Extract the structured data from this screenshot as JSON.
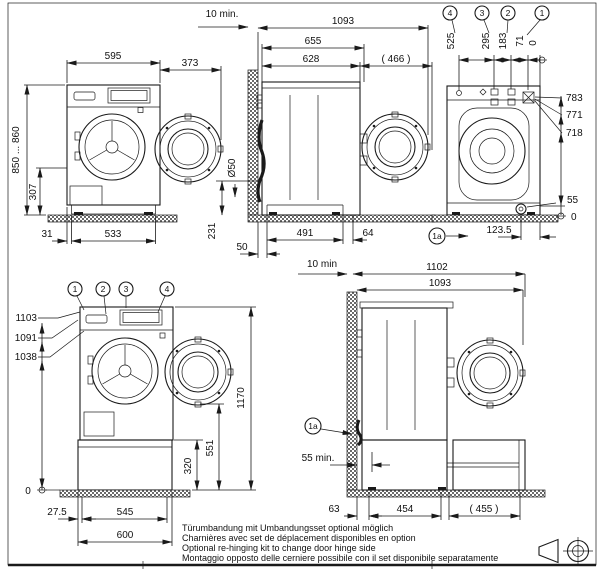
{
  "front": {
    "w": "595",
    "door": "373",
    "h": "850 ... 860",
    "drain_h": "307",
    "inset": "31",
    "base": "533"
  },
  "side": {
    "gap": "10 min.",
    "total": "1093",
    "with_door": "655",
    "body": "628",
    "swing": "( 466 )",
    "drain_dia": "Ø50",
    "drain_h": "231",
    "rear": "50",
    "base": "491",
    "front": "64"
  },
  "rear": {
    "c1": "1",
    "c2": "2",
    "c3": "3",
    "c4": "4",
    "c1a": "1a",
    "p4": "525",
    "p3": "295",
    "p2": "183",
    "p1": "71",
    "p0": "0",
    "h1": "783",
    "h2": "771",
    "h3": "718",
    "hd": "55",
    "h0": "0",
    "dx": "123.5"
  },
  "front_ped": {
    "c1": "1",
    "c2": "2",
    "c3": "3",
    "c4": "4",
    "h1": "1103",
    "h2": "1091",
    "h3": "1038",
    "h0": "0",
    "total": "1170",
    "door": "551",
    "ped": "320",
    "inset": "27.5",
    "feet": "545",
    "base": "600"
  },
  "side_ped": {
    "gap": "10 min",
    "total": "1102",
    "with_door": "1093",
    "c1a": "1a",
    "clear": "55 min.",
    "rear": "63",
    "body": "454",
    "drawer": "( 455 )"
  },
  "notes": {
    "de": "Türumbandung mit Umbandungsset optional möglich",
    "fr": "Charnières avec set de déplacement disponibles en option",
    "en": "Optional re-hinging kit to change door hinge side",
    "it": "Montaggio opposto delle cerniere possibile con il set disponibile separatamente"
  },
  "icons": {
    "projection_cone": "first-angle-projection-cone-icon",
    "projection_target": "first-angle-projection-target-icon"
  },
  "colors": {
    "line": "#1a1a1a",
    "background": "#ffffff"
  }
}
